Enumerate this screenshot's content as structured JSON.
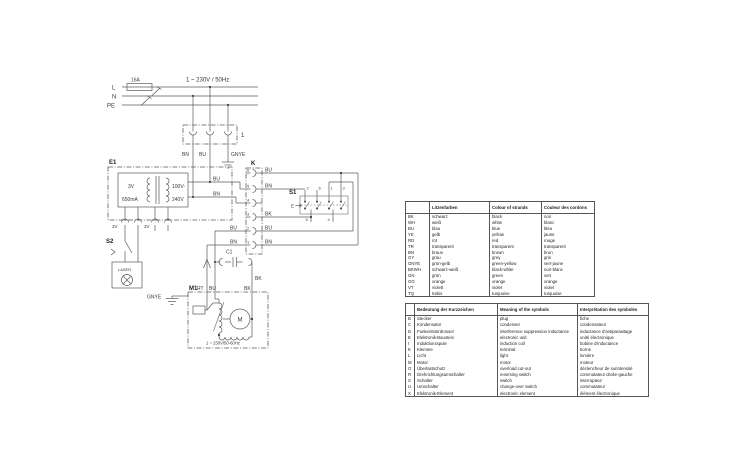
{
  "schematic": {
    "rails": {
      "l": "L",
      "n": "N",
      "pe": "PE"
    },
    "fuse": "16A",
    "supply": "1 ~ 230V / 50Hz",
    "connector1": "1",
    "wires": {
      "bn": "BN",
      "bu": "BU",
      "gnye": "GNYE",
      "bk": "BK",
      "rt": "RT"
    },
    "e1": {
      "ref": "E1",
      "sec_voltage": "3V",
      "sec_current": "650mA",
      "prim_min": "100V-",
      "prim_max": "240V"
    },
    "plug_3v": "3V",
    "k": {
      "ref": "K",
      "contacts": [
        "6",
        "5",
        "4",
        "3",
        "2",
        "1"
      ]
    },
    "s1": {
      "ref": "S1",
      "top": [
        "2",
        "6",
        "1",
        "3"
      ],
      "bottom": [
        "5",
        "4"
      ],
      "actuator": "E"
    },
    "s2": {
      "ref": "S2"
    },
    "laser": "LASER",
    "c1": "C1",
    "m1": {
      "ref": "M1",
      "motor": "M",
      "rating": "1 ~ 230V/50-60Hz"
    }
  },
  "color_table": {
    "headers": [
      "",
      "Litzenfarben",
      "Colour of strands",
      "Couleur des cordons"
    ],
    "rows": [
      [
        "BK",
        "schwarz",
        "black",
        "noir"
      ],
      [
        "WH",
        "weiß",
        "white",
        "blanc"
      ],
      [
        "BU",
        "blau",
        "blue",
        "bleu"
      ],
      [
        "YE",
        "gelb",
        "yellow",
        "jaune"
      ],
      [
        "RD",
        "rot",
        "red",
        "rouge"
      ],
      [
        "TR",
        "transparent",
        "transparent",
        "transparent"
      ],
      [
        "BN",
        "braun",
        "brown",
        "brun"
      ],
      [
        "GY",
        "grau",
        "grey",
        "gris"
      ],
      [
        "GNYE",
        "grün-gelb",
        "green-yellow",
        "vert-jaune"
      ],
      [
        "BKWH",
        "schwarz-weiß",
        "black-white",
        "noir-blanc"
      ],
      [
        "GN",
        "grün",
        "green",
        "vert"
      ],
      [
        "OG",
        "orange",
        "orange",
        "orange"
      ],
      [
        "VT",
        "violett",
        "violet",
        "violet"
      ],
      [
        "TQ",
        "türkis",
        "turquoise",
        "turquoise"
      ]
    ]
  },
  "symbol_table": {
    "headers": [
      "",
      "Bedeutung der Kurzzeichen",
      "Meaning of the symbols",
      "Interprétation des symboles"
    ],
    "rows": [
      [
        "B",
        "Stecker",
        "plug",
        "fiche"
      ],
      [
        "C",
        "Kondensator",
        "condenser",
        "condensateur"
      ],
      [
        "D",
        "Funkentstördrossel",
        "interference suppression inductance",
        "inductance d'antiparasitage"
      ],
      [
        "E",
        "Elektronik-Baustein",
        "electronic unit",
        "unité électronique"
      ],
      [
        "I",
        "Induktionsspule",
        "induction coil",
        "bobine d'inductance"
      ],
      [
        "K",
        "Klemme",
        "terminal",
        "borne"
      ],
      [
        "L",
        "Licht",
        "light",
        "lumière"
      ],
      [
        "M",
        "Motor",
        "motor",
        "moteur"
      ],
      [
        "O",
        "Überlastschutz",
        "overload cut-out",
        "déclencheur de surintensité"
      ],
      [
        "R",
        "Drehrichtungsumschalter",
        "reversing switch",
        "commutateur droite-gauche"
      ],
      [
        "S",
        "Schalter",
        "switch",
        "interrupteur"
      ],
      [
        "U",
        "Umschalter",
        "change-over switch",
        "commutateur"
      ],
      [
        "X",
        "Elektronik-Element",
        "electronic element",
        "élément électronique"
      ]
    ]
  }
}
